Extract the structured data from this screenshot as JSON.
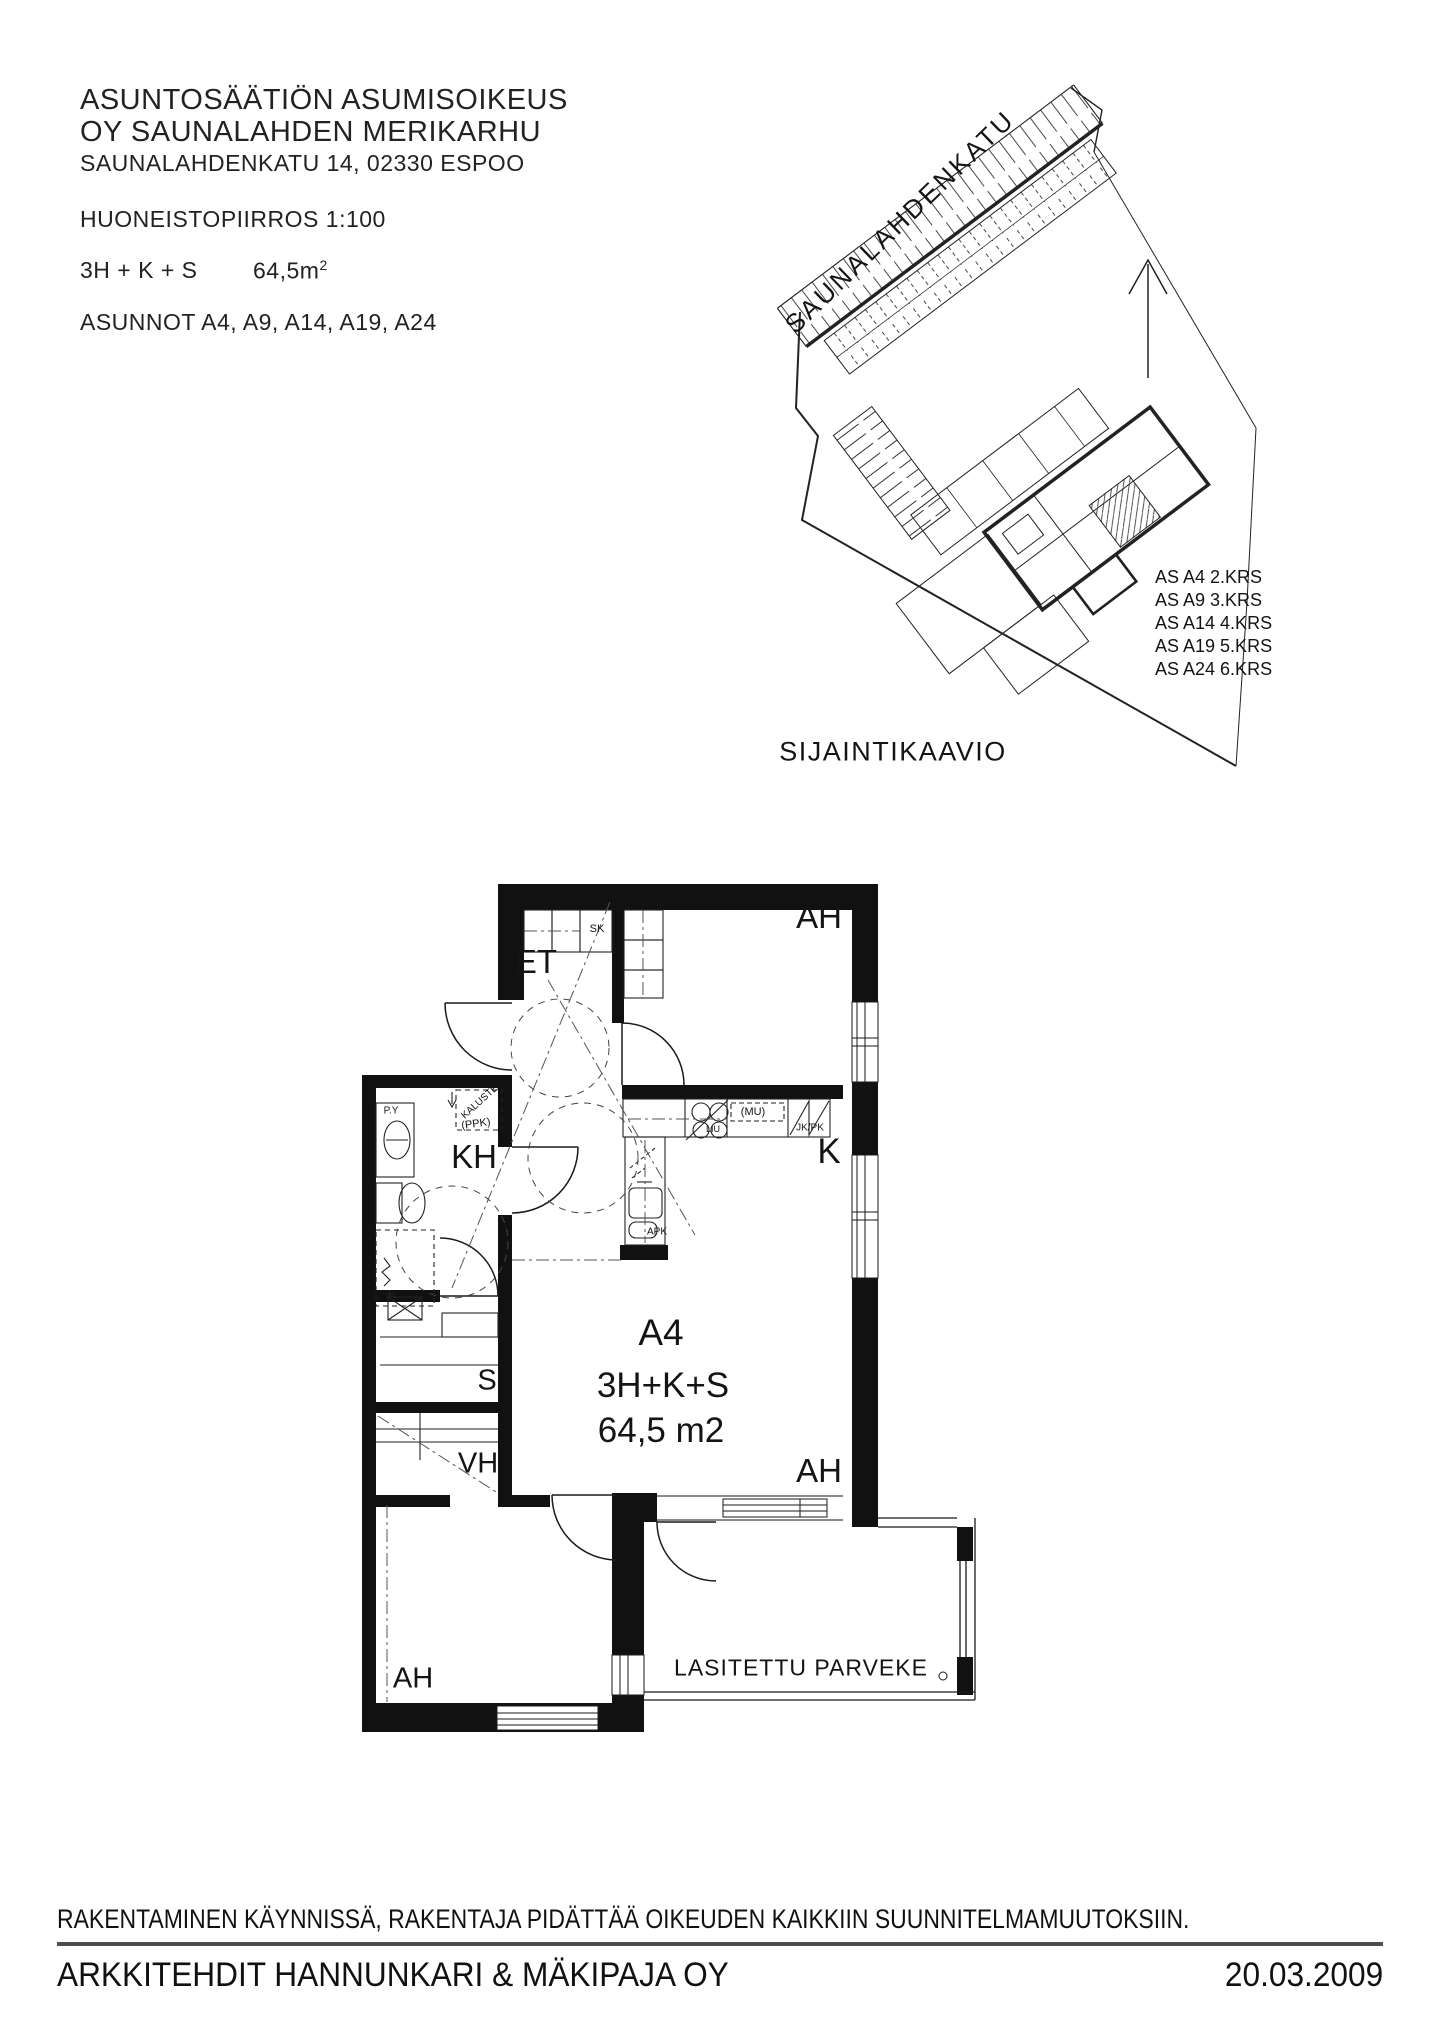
{
  "header": {
    "line1": "ASUNTOSÄÄTIÖN ASUMISOIKEUS",
    "line2": "OY SAUNALAHDEN MERIKARHU",
    "address": "SAUNALAHDENKATU 14, 02330 ESPOO",
    "drawing_label": "HUONEISTOPIIRROS 1:100",
    "apartment_type": "3H + K + S",
    "area": "64,5m",
    "area_sup": "2",
    "apartments": "ASUNNOT A4, A9, A14, A19, A24"
  },
  "site": {
    "street": "SAUNALAHDENKATU",
    "title": "SIJAINTIKAAVIO",
    "floors": [
      "AS A4 2.KRS",
      "AS A9 3.KRS",
      "AS A14 4.KRS",
      "AS A19 5.KRS",
      "AS A24 6.KRS"
    ]
  },
  "plan": {
    "apartment_id": "A4",
    "type": "3H+K+S",
    "area": "64,5 m2",
    "balcony": "LASITETTU PARVEKE",
    "rooms": {
      "et": "ET",
      "kh": "KH",
      "s": "S",
      "vh": "VH",
      "k": "K",
      "ah": "AH"
    },
    "fixtures": {
      "sk": "SK",
      "py": "P.Y",
      "kaluste": "KALUSTE",
      "ppk": "(PPK)",
      "mu": "(MU)",
      "jkpk": "JK/PK",
      "apk": "APK",
      "liu": "LIU"
    }
  },
  "footer": {
    "disclaimer": "RAKENTAMINEN KÄYNNISSÄ, RAKENTAJA PIDÄTTÄÄ OIKEUDEN KAIKKIIN SUUNNITELMAMUUTOKSIIN.",
    "company": "ARKKITEHDIT HANNUNKARI & MÄKIPAJA OY",
    "date": "20.03.2009"
  },
  "colors": {
    "ink": "#1a1a1a",
    "wall": "#111111",
    "rule": "#4d4d4d"
  }
}
